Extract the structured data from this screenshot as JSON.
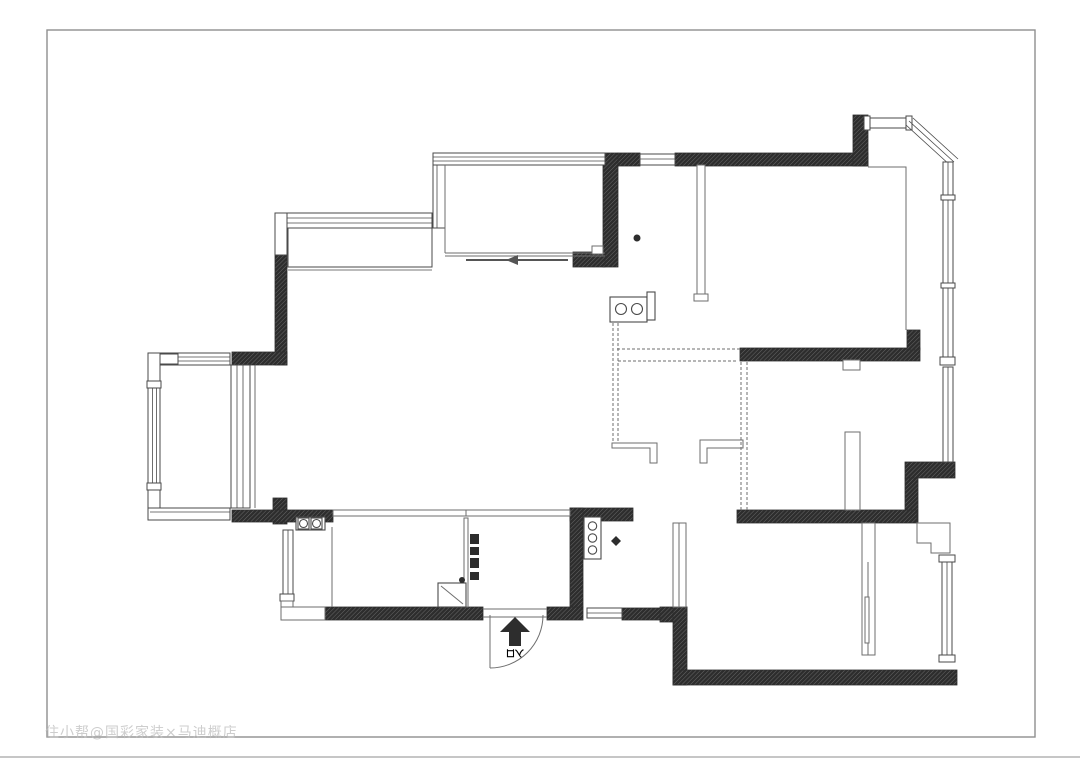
{
  "page": {
    "watermark": "住小帮@国彩家装×马迪概店"
  },
  "floor_plan": {
    "entrance_label": "入口",
    "colors": {
      "wall": "#2d2d2d",
      "line": "#4a4a4a",
      "thin": "#6e6e6e",
      "watermark": "#bdbdbd",
      "page_border": "#8f8f8f"
    },
    "icons": [
      "entrance-arrow-icon",
      "door-swing-arc",
      "sliding-door-arrow-icon"
    ],
    "fixtures": [
      "double-basin-vanity",
      "two-burner-hob",
      "three-burner-stove",
      "shoe-cabinet",
      "bay-window",
      "floor-drain-dot",
      "diamond-marker"
    ]
  }
}
